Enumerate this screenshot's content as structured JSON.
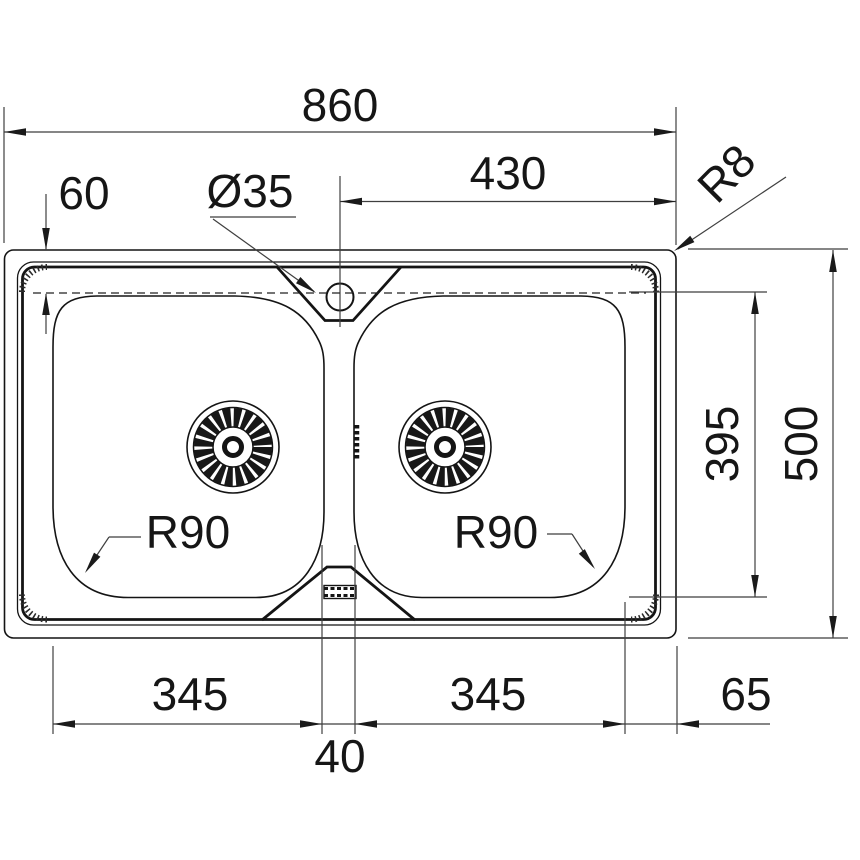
{
  "drawing": {
    "type": "technical-dimension-drawing",
    "background_color": "#ffffff",
    "line_color": "#141414",
    "dimension_color": "#3f3f3f",
    "labels": {
      "overall_width": "860",
      "faucet_center_to_right_edge": "430",
      "top_edge_to_bowl": "60",
      "faucet_hole_diameter": "Ø35",
      "outer_corner_radius": "R8",
      "bowl_inner_length": "395",
      "overall_depth": "500",
      "left_bowl_corner_radius": "R90",
      "right_bowl_corner_radius": "R90",
      "left_bowl_width": "345",
      "right_bowl_width": "345",
      "center_divider_gap": "40",
      "bowl_to_side_edge": "65"
    }
  }
}
